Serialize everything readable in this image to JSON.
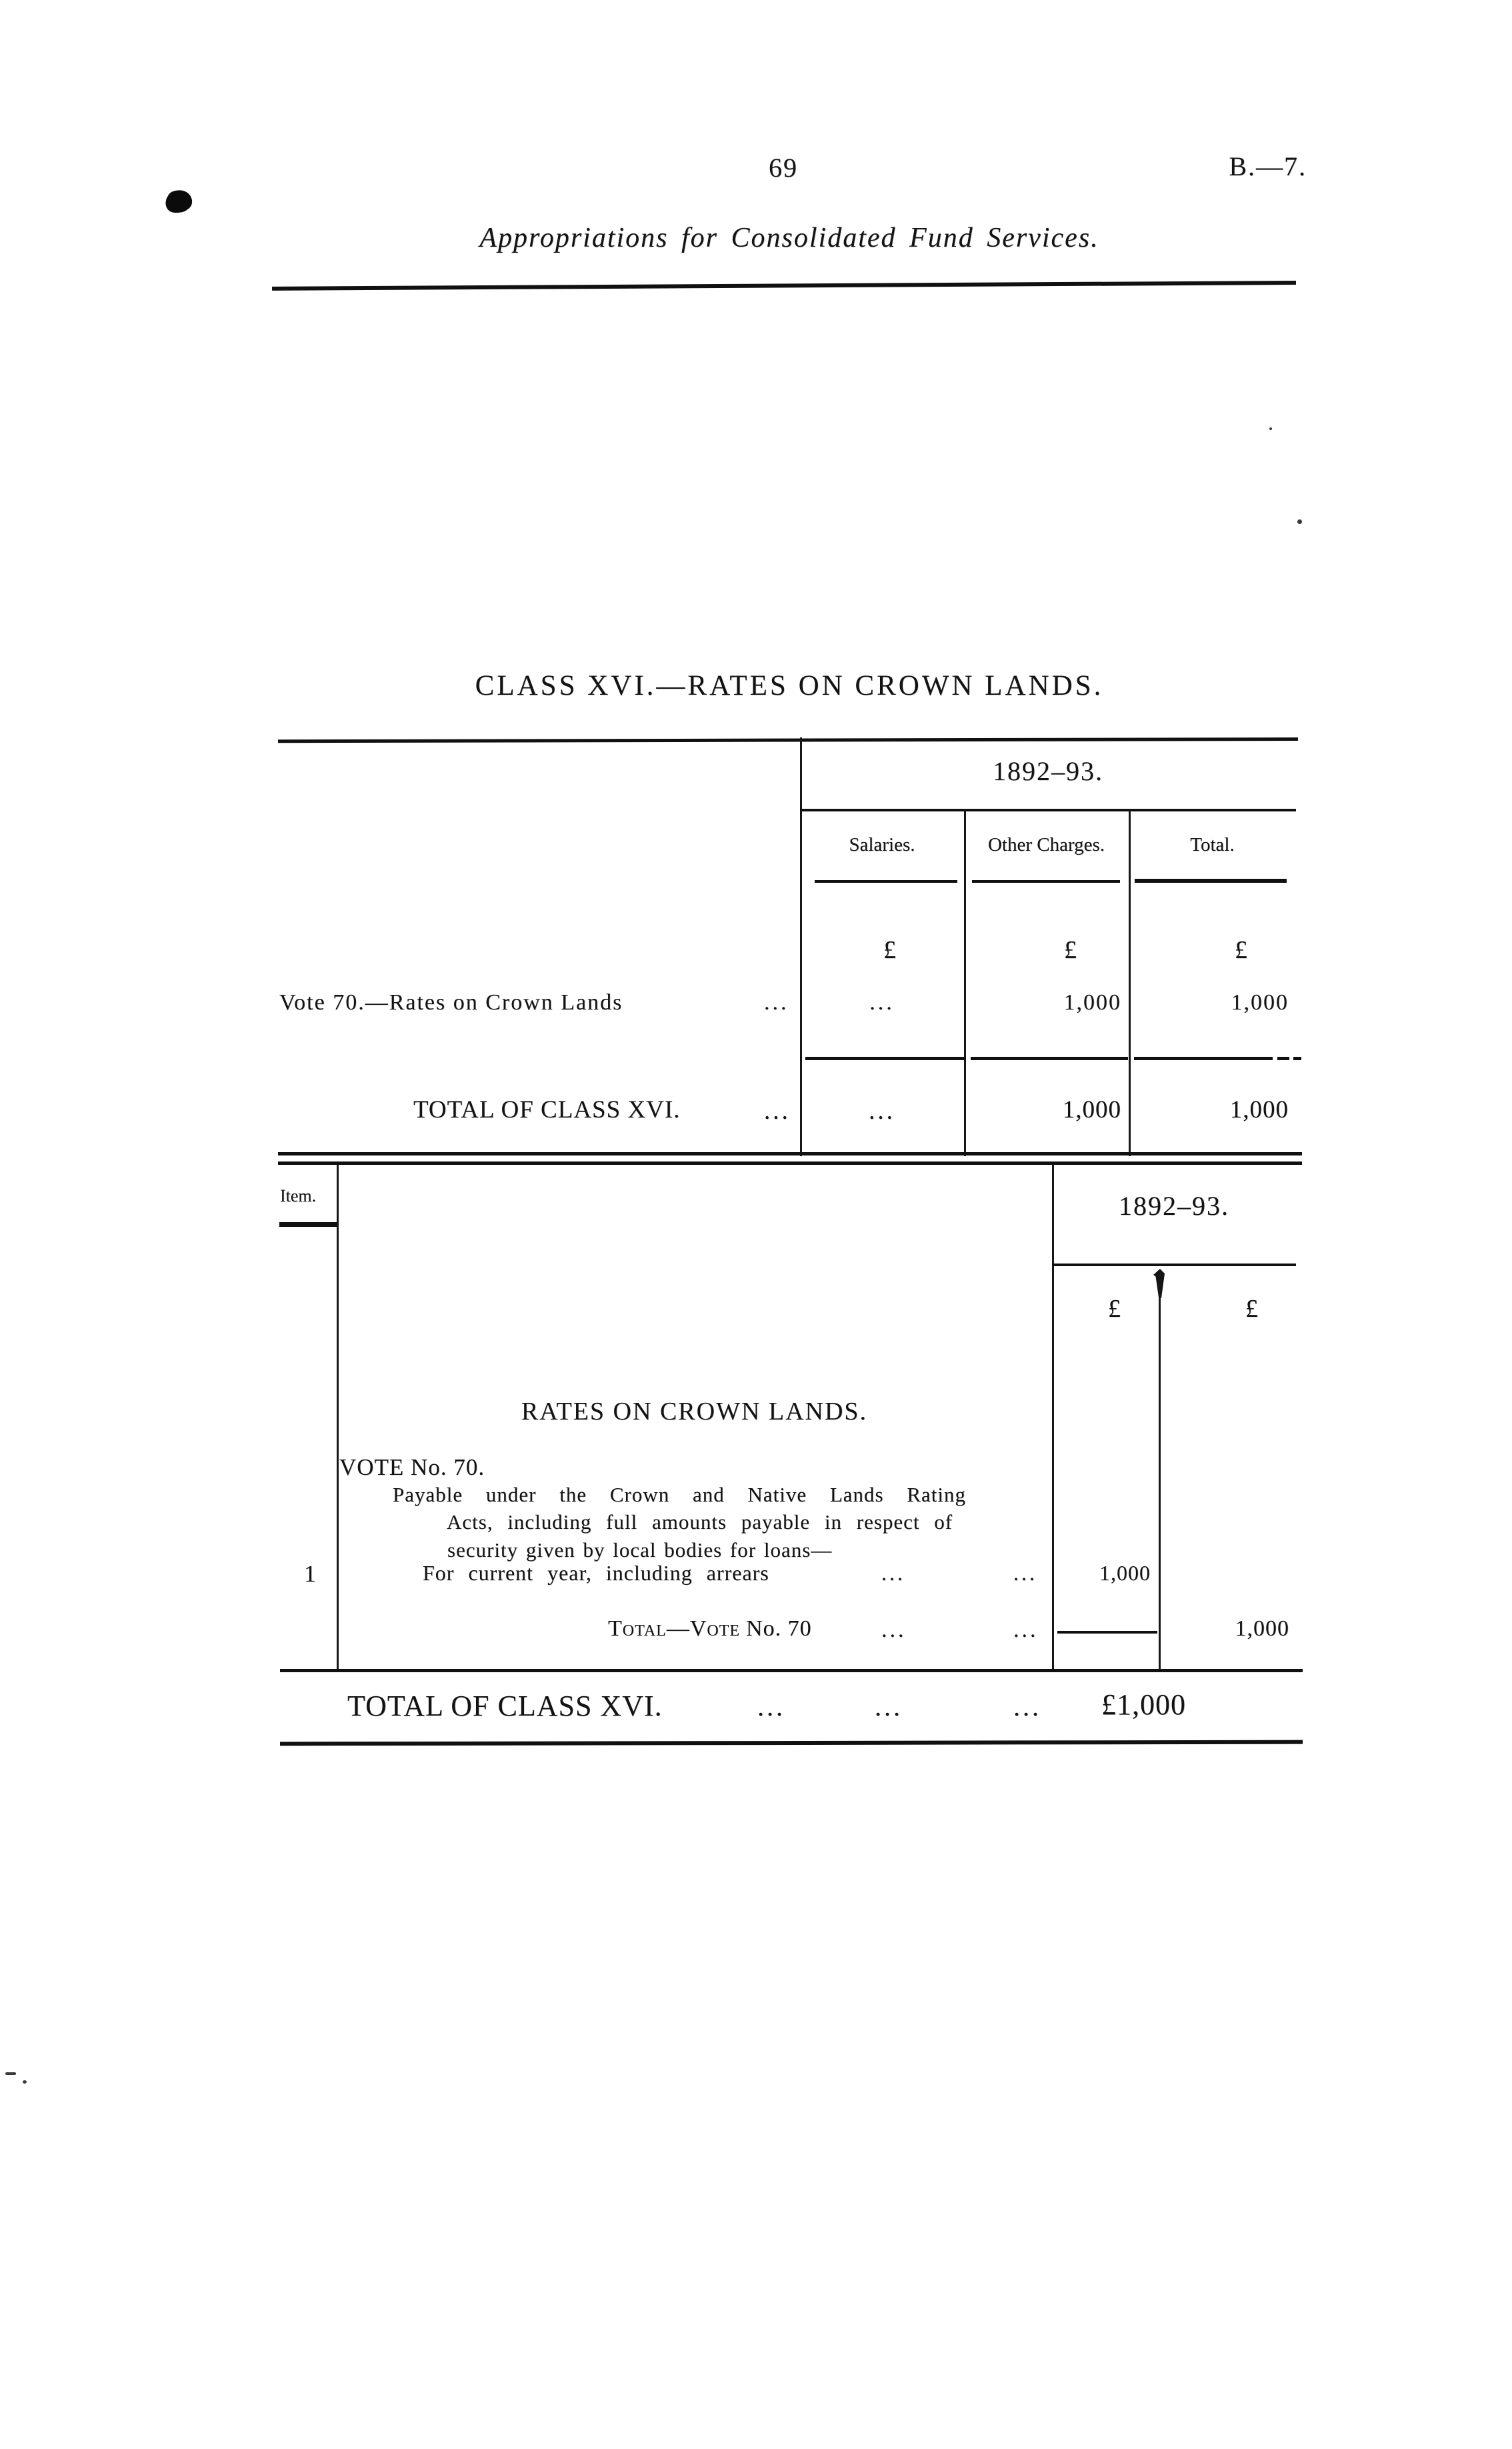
{
  "page": {
    "number": "69",
    "reference": "B.—7.",
    "running_title": "Appropriations for Consolidated Fund Services.",
    "class_heading": "CLASS XVI.—RATES ON CROWN LANDS.",
    "leader": "..."
  },
  "summary_table": {
    "year_header": "1892–93.",
    "col_salaries": "Salaries.",
    "col_other_charges": "Other Charges.",
    "col_total": "Total.",
    "pound": "£",
    "rows": [
      {
        "label": "Vote 70.—Rates on Crown Lands",
        "salaries": "...",
        "other_charges": "1,000",
        "total": "1,000"
      },
      {
        "label": "TOTAL OF CLASS XVI.",
        "salaries": "...",
        "other_charges": "1,000",
        "total": "1,000"
      }
    ]
  },
  "detail_table": {
    "item_header": "Item.",
    "year_header": "1892–93.",
    "pound": "£",
    "group_heading": "RATES ON CROWN LANDS.",
    "vote_heading": "VOTE No. 70.",
    "description_line1": "Payable under the Crown and Native Lands Rating",
    "description_line2": "Acts, including full amounts payable in respect of",
    "description_line3": "security given by local bodies for loans—",
    "item_number": "1",
    "item_label": "For current year, including arrears",
    "item_amount": "1,000",
    "total_label_smallcaps": "Total—Vote",
    "total_label_rest": "No. 70",
    "total_amount": "1,000"
  },
  "grand_total": {
    "label": "TOTAL OF CLASS XVI.",
    "amount": "£1,000"
  },
  "colors": {
    "ink": "#131313",
    "paper": "#ffffff"
  }
}
